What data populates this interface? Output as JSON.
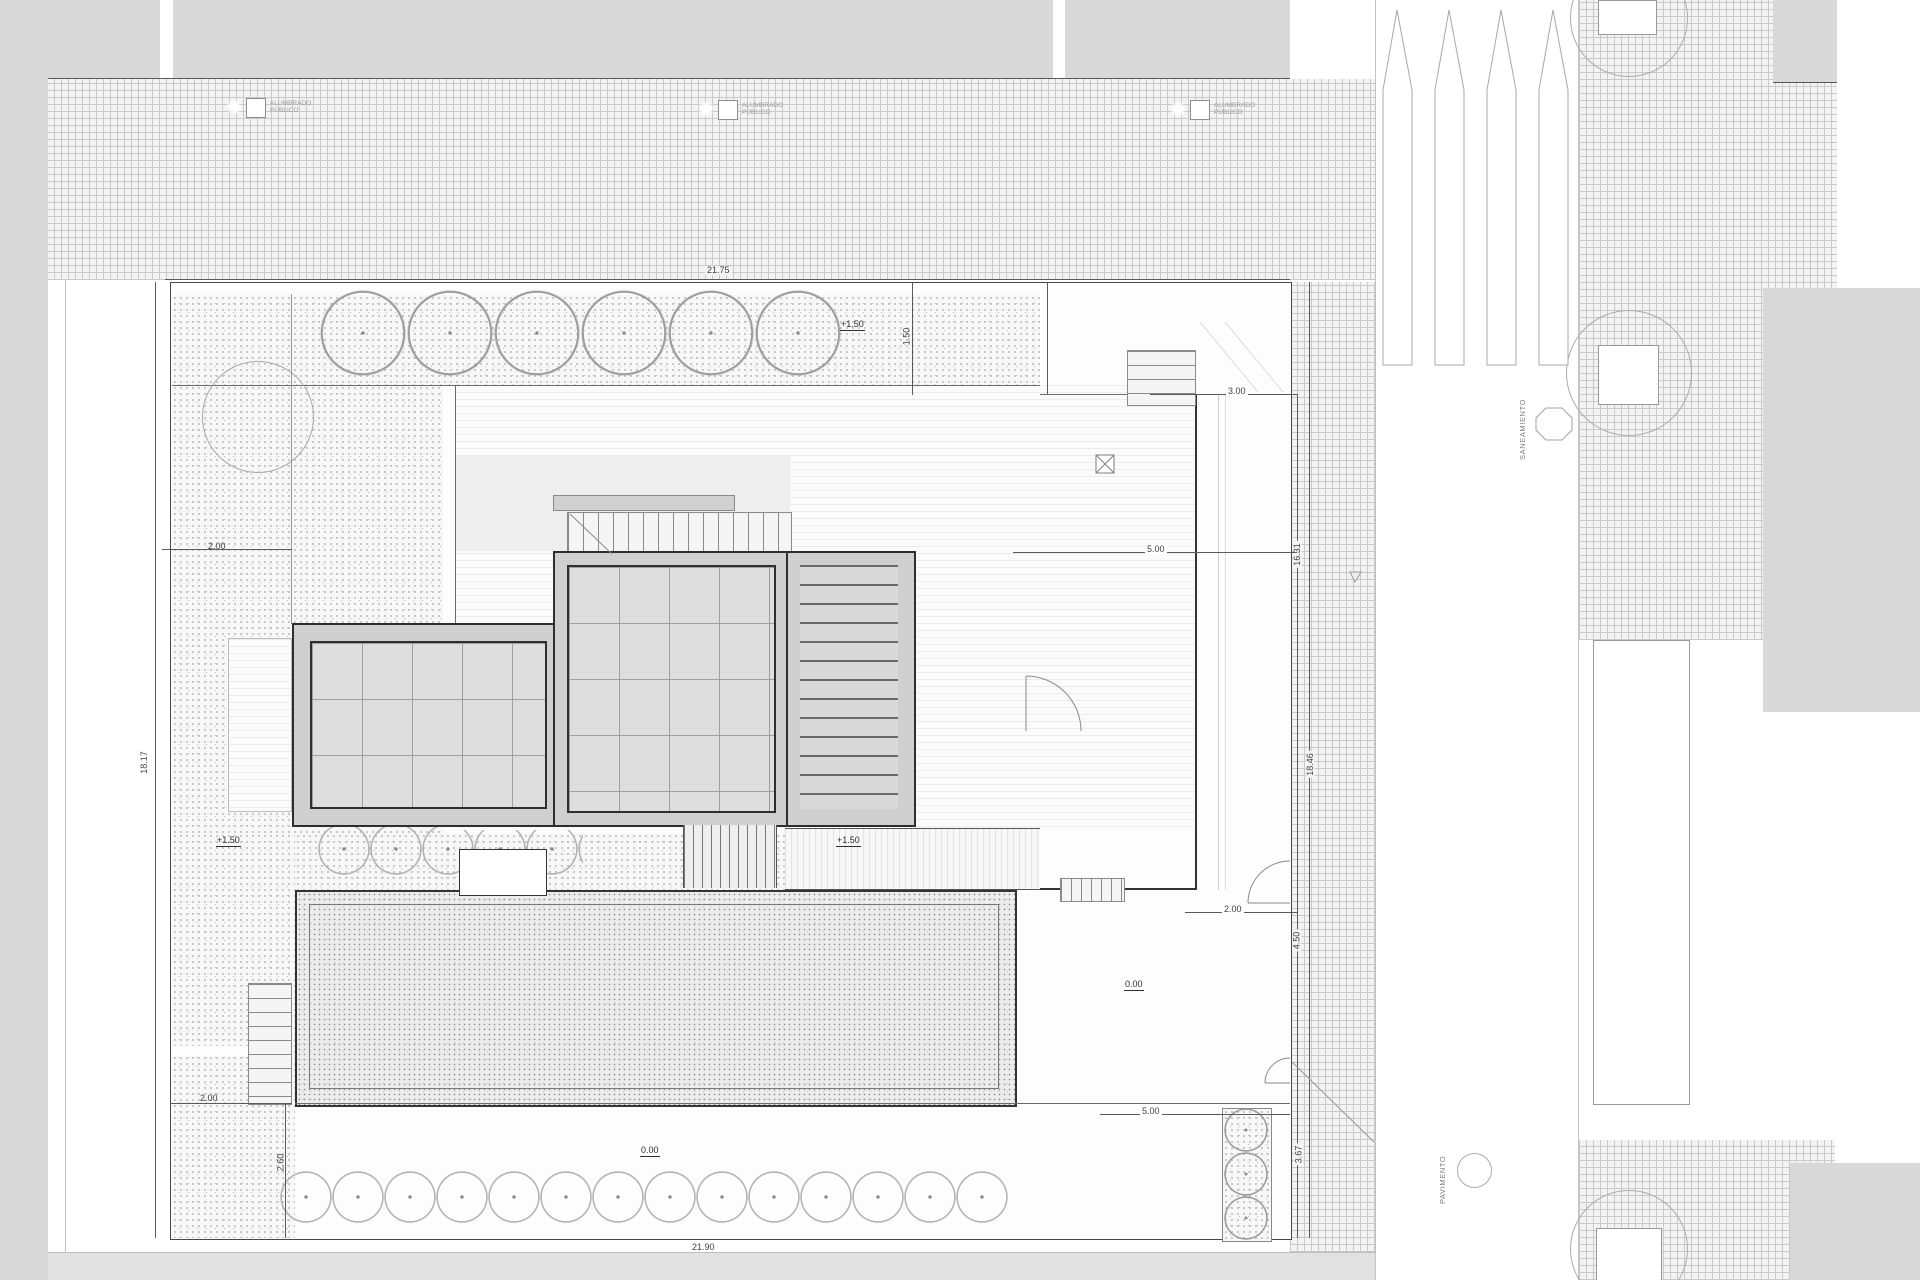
{
  "labels": {
    "street_light": {
      "line1": "ALUMBRADO",
      "line2": "PÚBLICO"
    },
    "saneamiento": "SANEAMIENTO",
    "pavimento": "PAVIMENTO",
    "acometida_line1": "ALUMBRADO",
    "acometida_line2": "PÚBLICO"
  },
  "dimensions": {
    "top": "21.75",
    "bottom": "21.90",
    "left": "18.17",
    "right_full": "18.46",
    "right_lower": "16.31",
    "right_450": "4.50",
    "right_367": "3.67",
    "top_right_300": "3.00",
    "mid_500": "5.00",
    "gate_200": "2.00",
    "low_500": "5.00",
    "left_200_top": "2.00",
    "left_200_bottom": "2.00",
    "left_260": "2.60",
    "top_150": "1.50"
  },
  "levels": {
    "garden_top": "+1.50",
    "garden_left": "+1.50",
    "deck": "+1.50",
    "courtyard": "0.00",
    "entry": "0.00"
  }
}
